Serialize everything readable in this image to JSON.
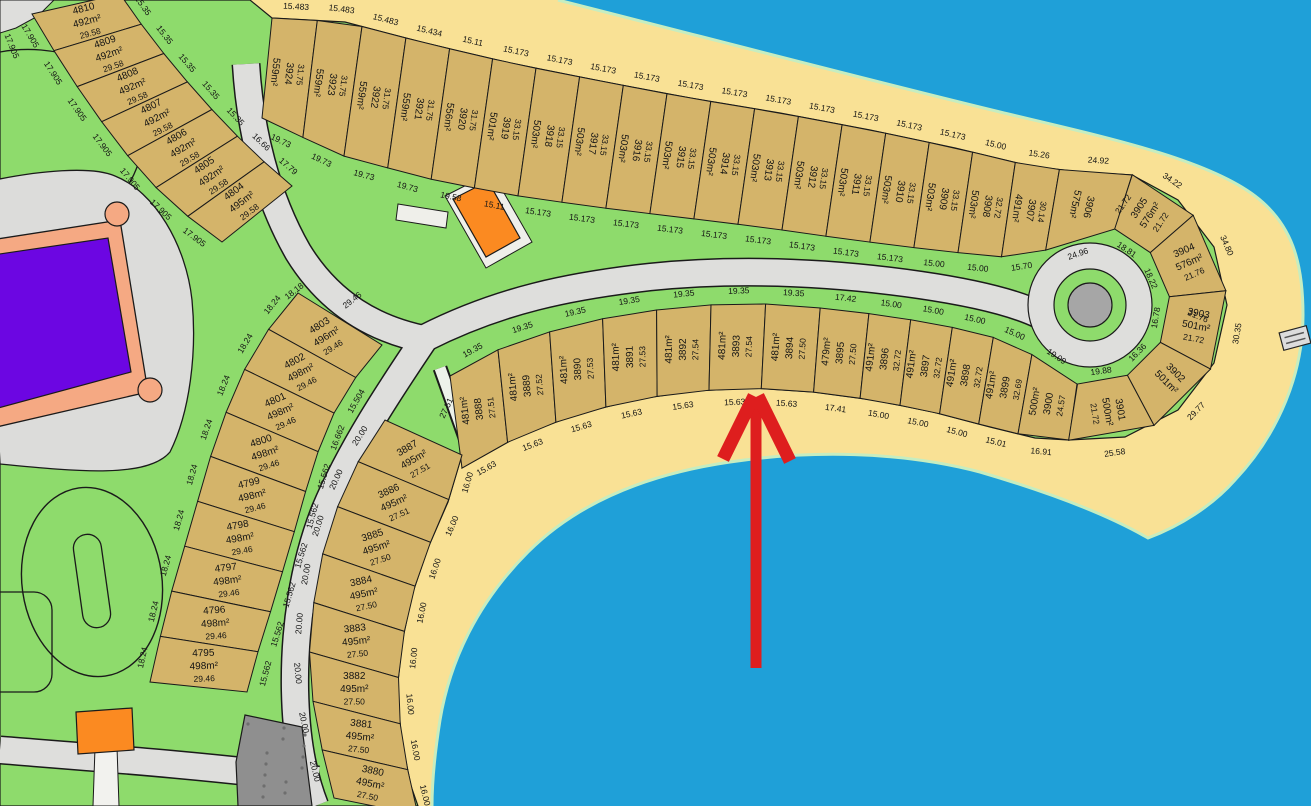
{
  "map_title": "Subdivision parcel map with beach lots",
  "colors": {
    "water": "#1FA0D8",
    "sand": "#F9E195",
    "grass": "#8EDB6C",
    "lot": "#D4B46A",
    "road": "#DEDEDC",
    "road_dark": "#8F8F8F",
    "outline": "#1a1a1a",
    "purple": "#6C06E2",
    "salmon": "#F5A983",
    "orange": "#FB8A21",
    "arrow": "#DE1E1E",
    "shore": "#C6EDC0",
    "culdesac_center": "#A6A6A6",
    "pad": "#EFE FEA",
    "text": "#141414"
  },
  "bands": [
    {
      "name": "beach-band-north",
      "mode": "columns-top",
      "inner": [
        [
          262,
          118
        ],
        [
          340,
          155
        ],
        [
          425,
          178
        ],
        [
          505,
          194
        ],
        [
          588,
          206
        ],
        [
          678,
          217
        ],
        [
          768,
          228
        ],
        [
          853,
          240
        ],
        [
          933,
          250
        ],
        [
          1000,
          257
        ],
        [
          1060,
          248
        ],
        [
          1115,
          229
        ]
      ],
      "outer": [
        [
          272,
          18
        ],
        [
          345,
          22
        ],
        [
          425,
          43
        ],
        [
          510,
          63
        ],
        [
          600,
          81
        ],
        [
          690,
          98
        ],
        [
          780,
          113
        ],
        [
          870,
          130
        ],
        [
          955,
          148
        ],
        [
          1030,
          166
        ],
        [
          1080,
          172
        ],
        [
          1132,
          175
        ]
      ],
      "widths": [
        15.5,
        15.5,
        15.5,
        15.4,
        15.1,
        15.2,
        15.2,
        15.2,
        15.2,
        15.2,
        15.2,
        15.2,
        15.2,
        15.2,
        15.2,
        15.2,
        15.0,
        15.3,
        24.9
      ],
      "numbers": [
        "3924",
        "3923",
        "3922",
        "3921",
        "3920",
        "3919",
        "3918",
        "3917",
        "3916",
        "3915",
        "3914",
        "3913",
        "3912",
        "3911",
        "3910",
        "3909",
        "3908",
        "3907",
        "3906"
      ],
      "areas": [
        "559m²",
        "559m²",
        "559m²",
        "559m²",
        "556m²",
        "501m²",
        "503m²",
        "503m²",
        "503m²",
        "503m²",
        "503m²",
        "503m²",
        "503m²",
        "503m²",
        "503m²",
        "503m²",
        "503m²",
        "491m²",
        "575m²"
      ],
      "dims": [
        "31.75",
        "31.75",
        "31.75",
        "31.75",
        "31.75",
        "33.15",
        "33.15",
        "33.15",
        "33.15",
        "33.15",
        "33.15",
        "33.15",
        "33.15",
        "33.15",
        "33.15",
        "33.15",
        "32.72",
        "30.14",
        ""
      ],
      "outerDims": [
        "15.483",
        "15.483",
        "15.483",
        "15.434",
        "15.11",
        "15.173",
        "15.173",
        "15.173",
        "15.173",
        "15.173",
        "15.173",
        "15.173",
        "15.173",
        "15.173",
        "15.173",
        "15.173",
        "15.00",
        "15.26",
        "24.92"
      ],
      "innerDims": [
        "19.73",
        "19.73",
        "19.73",
        "19.73",
        "19.58",
        "15.11",
        "15.173",
        "15.173",
        "15.173",
        "15.173",
        "15.173",
        "15.173",
        "15.173",
        "15.173",
        "15.173",
        "15.00",
        "15.00",
        "15.70",
        "24.96"
      ]
    },
    {
      "name": "beach-band-middle",
      "mode": "columns-bottom",
      "inner": [
        [
          450,
          376
        ],
        [
          505,
          346
        ],
        [
          565,
          327
        ],
        [
          625,
          314
        ],
        [
          688,
          306
        ],
        [
          750,
          303
        ],
        [
          812,
          307
        ],
        [
          872,
          314
        ],
        [
          932,
          323
        ],
        [
          988,
          335
        ],
        [
          1035,
          356
        ],
        [
          1077,
          384
        ]
      ],
      "outer": [
        [
          462,
          468
        ],
        [
          517,
          437
        ],
        [
          575,
          415
        ],
        [
          633,
          400
        ],
        [
          693,
          391
        ],
        [
          753,
          388
        ],
        [
          813,
          392
        ],
        [
          873,
          400
        ],
        [
          933,
          412
        ],
        [
          990,
          427
        ],
        [
          1035,
          438
        ],
        [
          1069,
          440
        ]
      ],
      "widths": [
        19.4,
        19.4,
        19.4,
        19.4,
        19.4,
        19.4,
        19.4,
        17.4,
        15,
        15,
        15,
        15,
        19.1
      ],
      "numbers": [
        "3888",
        "3889",
        "3890",
        "3891",
        "3892",
        "3893",
        "3894",
        "3895",
        "3896",
        "3897",
        "3898",
        "3899",
        "3900"
      ],
      "areas": [
        "481m²",
        "481m²",
        "481m²",
        "481m²",
        "481m²",
        "481m²",
        "481m²",
        "479m²",
        "491m²",
        "491m²",
        "491m²",
        "491m²",
        "500m²"
      ],
      "dims": [
        "27.51",
        "27.52",
        "27.53",
        "27.53",
        "27.54",
        "27.54",
        "27.50",
        "27.50",
        "32.72",
        "32.72",
        "32.72",
        "32.69",
        "24.57"
      ],
      "innerDims": [
        "19.35",
        "19.35",
        "19.35",
        "19.35",
        "19.35",
        "19.35",
        "19.35",
        "17.42",
        "15.00",
        "15.00",
        "15.00",
        "15.00",
        "19.09"
      ],
      "outerDims": [
        "15.63",
        "15.63",
        "15.63",
        "15.63",
        "15.63",
        "15.63",
        "15.63",
        "17.41",
        "15.00",
        "15.00",
        "15.00",
        "15.01",
        "16.91"
      ]
    },
    {
      "name": "culdesac-head-band",
      "mode": "stack",
      "arc": {
        "cx": 1090,
        "cy": 305,
        "a0": -72,
        "a1": 99,
        "r0": 80,
        "r1": 137
      },
      "widths": [
        31,
        35,
        34,
        34,
        37
      ],
      "numbers": [
        "3905",
        "3904",
        "3903",
        "3902",
        "3901"
      ],
      "areas": [
        "576m²",
        "576m²",
        "501m²",
        "501m²",
        "500m²"
      ],
      "dims": [
        "21.72",
        "21.76",
        "21.72",
        "",
        "21.72"
      ],
      "outerDims": [
        "34.22",
        "34.80",
        "30.35",
        "29.77",
        "25.58"
      ],
      "innerDims": [
        "18.81",
        "18.22",
        "16.78",
        "16.36",
        "19.88"
      ]
    },
    {
      "name": "west-band-upper",
      "mode": "stack",
      "inner": [
        [
          32,
          14
        ],
        [
          56,
          54
        ],
        [
          84,
          97
        ],
        [
          114,
          139
        ],
        [
          146,
          178
        ],
        [
          182,
          212
        ],
        [
          222,
          242
        ]
      ],
      "outer": [
        [
          120,
          -6
        ],
        [
          144,
          28
        ],
        [
          172,
          64
        ],
        [
          202,
          99
        ],
        [
          232,
          131
        ],
        [
          262,
          160
        ],
        [
          292,
          186
        ]
      ],
      "widths": [
        1,
        1,
        1,
        1,
        1,
        1,
        1
      ],
      "numbers": [
        "4810",
        "4809",
        "4808",
        "4807",
        "4806",
        "4805",
        "4804"
      ],
      "areas": [
        "492m²",
        "492m²",
        "492m²",
        "492m²",
        "492m²",
        "492m²",
        "495m²"
      ],
      "dims": [
        "29.58",
        "29.58",
        "29.58",
        "29.58",
        "29.58",
        "29.58",
        "29.58"
      ],
      "innerDims": [
        "17.905",
        "17.905",
        "17.905",
        "17.905",
        "17.905",
        "17.905",
        "17.905"
      ],
      "outerDims": [
        "15.35",
        "15.35",
        "15.35",
        "15.35",
        "15.35",
        "16.66",
        "17.79"
      ]
    },
    {
      "name": "west-band-lower",
      "mode": "stack",
      "rots": [
        -32,
        -28,
        -24,
        -18,
        -14,
        -10,
        -7,
        -4,
        -2
      ],
      "inner": [
        [
          298,
          293
        ],
        [
          268,
          330
        ],
        [
          243,
          372
        ],
        [
          225,
          415
        ],
        [
          210,
          458
        ],
        [
          198,
          500
        ],
        [
          185,
          545
        ],
        [
          172,
          590
        ],
        [
          160,
          638
        ],
        [
          150,
          682
        ]
      ],
      "outer": [
        [
          382,
          345
        ],
        [
          352,
          382
        ],
        [
          330,
          420
        ],
        [
          315,
          460
        ],
        [
          303,
          500
        ],
        [
          292,
          540
        ],
        [
          280,
          580
        ],
        [
          268,
          620
        ],
        [
          256,
          658
        ],
        [
          247,
          692
        ]
      ],
      "widths": [
        1,
        1,
        1,
        1,
        1,
        1,
        1,
        1,
        1
      ],
      "numbers": [
        "4803",
        "4802",
        "4801",
        "4800",
        "4799",
        "4798",
        "4797",
        "4796",
        "4795"
      ],
      "areas": [
        "496m²",
        "498m²",
        "498m²",
        "498m²",
        "498m²",
        "498m²",
        "498m²",
        "498m²",
        "498m²"
      ],
      "dims": [
        "29.46",
        "29.46",
        "29.46",
        "29.46",
        "29.46",
        "29.46",
        "29.46",
        "29.46",
        "29.46"
      ],
      "innerDims": [
        "18.24",
        "18.24",
        "18.24",
        "18.24",
        "18.24",
        "18.24",
        "18.24",
        "18.24",
        "18.24"
      ],
      "outerDims": [
        "",
        "15.504",
        "16.662",
        "15.562",
        "15.562",
        "15.562",
        "15.562",
        "15.562",
        "15.562"
      ]
    },
    {
      "name": "south-band",
      "mode": "stack",
      "rots": [
        -30,
        -24,
        -18,
        -12,
        -6,
        0,
        6,
        12
      ],
      "inner": [
        [
          385,
          420
        ],
        [
          358,
          462
        ],
        [
          337,
          508
        ],
        [
          322,
          556
        ],
        [
          313,
          607
        ],
        [
          309,
          659
        ],
        [
          314,
          712
        ],
        [
          324,
          758
        ],
        [
          334,
          798
        ]
      ],
      "outer": [
        [
          462,
          455
        ],
        [
          448,
          502
        ],
        [
          428,
          548
        ],
        [
          412,
          595
        ],
        [
          402,
          643
        ],
        [
          397,
          692
        ],
        [
          402,
          742
        ],
        [
          411,
          786
        ],
        [
          418,
          815
        ]
      ],
      "widths": [
        1,
        1,
        1,
        1,
        1,
        1,
        1,
        1
      ],
      "numbers": [
        "3887",
        "3886",
        "3885",
        "3884",
        "3883",
        "3882",
        "3881",
        "3880"
      ],
      "areas": [
        "495m²",
        "495m²",
        "495m²",
        "495m²",
        "495m²",
        "495m²",
        "495m²",
        "495m²"
      ],
      "dims": [
        "27.51",
        "27.51",
        "27.50",
        "27.50",
        "27.50",
        "27.50",
        "27.50",
        "27.50"
      ],
      "innerDims": [
        "20.00",
        "20.00",
        "20.00",
        "20.00",
        "20.00",
        "20.00",
        "20.00",
        "20.00"
      ],
      "outerDims": [
        "16.00",
        "16.00",
        "16.00",
        "16.00",
        "16.00",
        "16.00",
        "16.00",
        "16.00"
      ]
    }
  ],
  "standalone_labels": [
    {
      "t": "17.905",
      "x": 12,
      "y": 46,
      "r": 68
    },
    {
      "t": "18.18",
      "x": 294,
      "y": 291,
      "r": -38
    },
    {
      "t": "29.46",
      "x": 352,
      "y": 300,
      "r": -38
    },
    {
      "t": "21.72",
      "x": 1123,
      "y": 204,
      "r": -55
    },
    {
      "t": "21.76",
      "x": 1198,
      "y": 316,
      "r": 22
    },
    {
      "t": "27.51",
      "x": 446,
      "y": 408,
      "r": -65
    }
  ],
  "arrow": {
    "tip_x": 756,
    "tip_y": 396,
    "tail_y": 668,
    "wing_left": [
      723,
      459
    ],
    "wing_right": [
      790,
      461
    ],
    "points_at": "15.63 frontage of lot 3894"
  }
}
